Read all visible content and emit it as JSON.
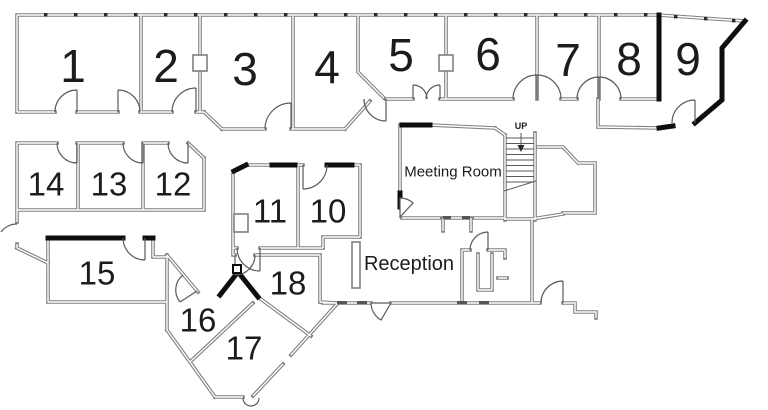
{
  "floorplan": {
    "title": "Office floor plan",
    "colors": {
      "wall": "#7f7f7f",
      "wall_bold": "#0e0e0e",
      "door": "#5a5a5a",
      "label": "#1c1c1c"
    },
    "labels": [
      {
        "id": "room-1",
        "text": "1",
        "x": 73,
        "y": 66,
        "size": 46
      },
      {
        "id": "room-2",
        "text": "2",
        "x": 166,
        "y": 66,
        "size": 46
      },
      {
        "id": "room-3",
        "text": "3",
        "x": 245,
        "y": 69,
        "size": 46
      },
      {
        "id": "room-4",
        "text": "4",
        "x": 327,
        "y": 67,
        "size": 46
      },
      {
        "id": "room-5",
        "text": "5",
        "x": 401,
        "y": 55,
        "size": 46
      },
      {
        "id": "room-6",
        "text": "6",
        "x": 488,
        "y": 54,
        "size": 46
      },
      {
        "id": "room-7",
        "text": "7",
        "x": 568,
        "y": 60,
        "size": 46
      },
      {
        "id": "room-8",
        "text": "8",
        "x": 629,
        "y": 59,
        "size": 46
      },
      {
        "id": "room-9",
        "text": "9",
        "x": 688,
        "y": 59,
        "size": 46
      },
      {
        "id": "room-10",
        "text": "10",
        "x": 328,
        "y": 211,
        "size": 33
      },
      {
        "id": "room-11",
        "text": "11",
        "x": 270,
        "y": 211,
        "size": 33
      },
      {
        "id": "room-12",
        "text": "12",
        "x": 173,
        "y": 184,
        "size": 33
      },
      {
        "id": "room-13",
        "text": "13",
        "x": 109,
        "y": 184,
        "size": 33
      },
      {
        "id": "room-14",
        "text": "14",
        "x": 46,
        "y": 184,
        "size": 33
      },
      {
        "id": "room-15",
        "text": "15",
        "x": 97,
        "y": 273,
        "size": 33
      },
      {
        "id": "room-16",
        "text": "16",
        "x": 198,
        "y": 320,
        "size": 33
      },
      {
        "id": "room-17",
        "text": "17",
        "x": 244,
        "y": 348,
        "size": 33
      },
      {
        "id": "room-18",
        "text": "18",
        "x": 288,
        "y": 283,
        "size": 33
      },
      {
        "id": "meeting-room",
        "text": "Meeting Room",
        "x": 453,
        "y": 172,
        "size": 15
      },
      {
        "id": "reception",
        "text": "Reception",
        "x": 409,
        "y": 264,
        "size": 20
      },
      {
        "id": "stairs-up",
        "text": "UP",
        "x": 521,
        "y": 126,
        "size": 9,
        "bold": true
      }
    ]
  }
}
